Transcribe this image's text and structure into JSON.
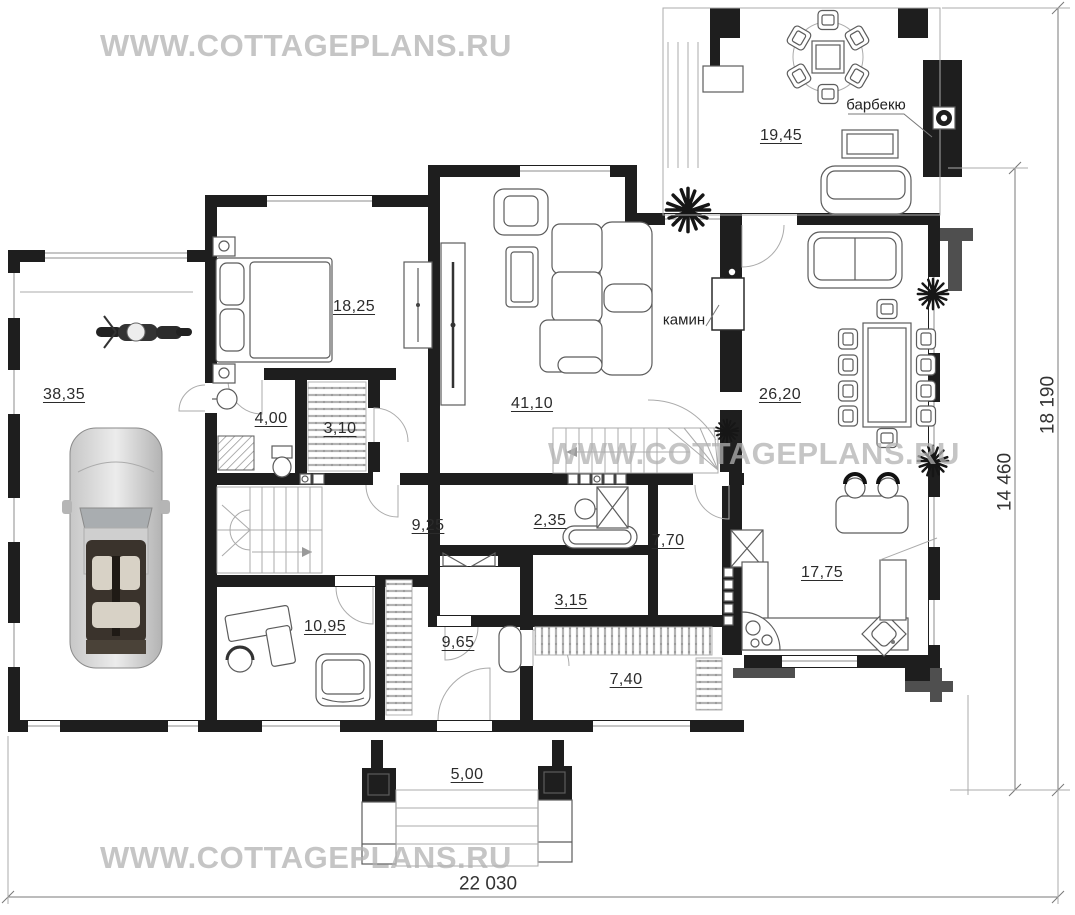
{
  "watermark": {
    "text": "WWW.COTTAGEPLANS.RU"
  },
  "rooms": {
    "garage": {
      "area": "38,35"
    },
    "bedroom": {
      "area": "18,25"
    },
    "bathroom_small": {
      "area": "4,00"
    },
    "closet": {
      "area": "3,10"
    },
    "living_room": {
      "area": "41,10"
    },
    "terrace": {
      "area": "19,45"
    },
    "dining_room": {
      "area": "26,20"
    },
    "hall": {
      "area": "9,25"
    },
    "bathroom": {
      "area": "2,35"
    },
    "pantry": {
      "area": "7,70"
    },
    "corridor": {
      "area": "3,15"
    },
    "study": {
      "area": "10,95"
    },
    "entry_hall": {
      "area": "9,65"
    },
    "wardrobe": {
      "area": "7,40"
    },
    "kitchen": {
      "area": "17,75"
    },
    "porch": {
      "area": "5,00"
    }
  },
  "annotations": {
    "fireplace": "камин",
    "barbecue": "барбекю"
  },
  "dimensions": {
    "overall_width": "22 030",
    "overall_depth": "18 190",
    "house_depth": "14 460"
  },
  "colors": {
    "wall": "#1e1e1e",
    "watermark": "#b2b2b2",
    "text": "#2b2b2b"
  }
}
